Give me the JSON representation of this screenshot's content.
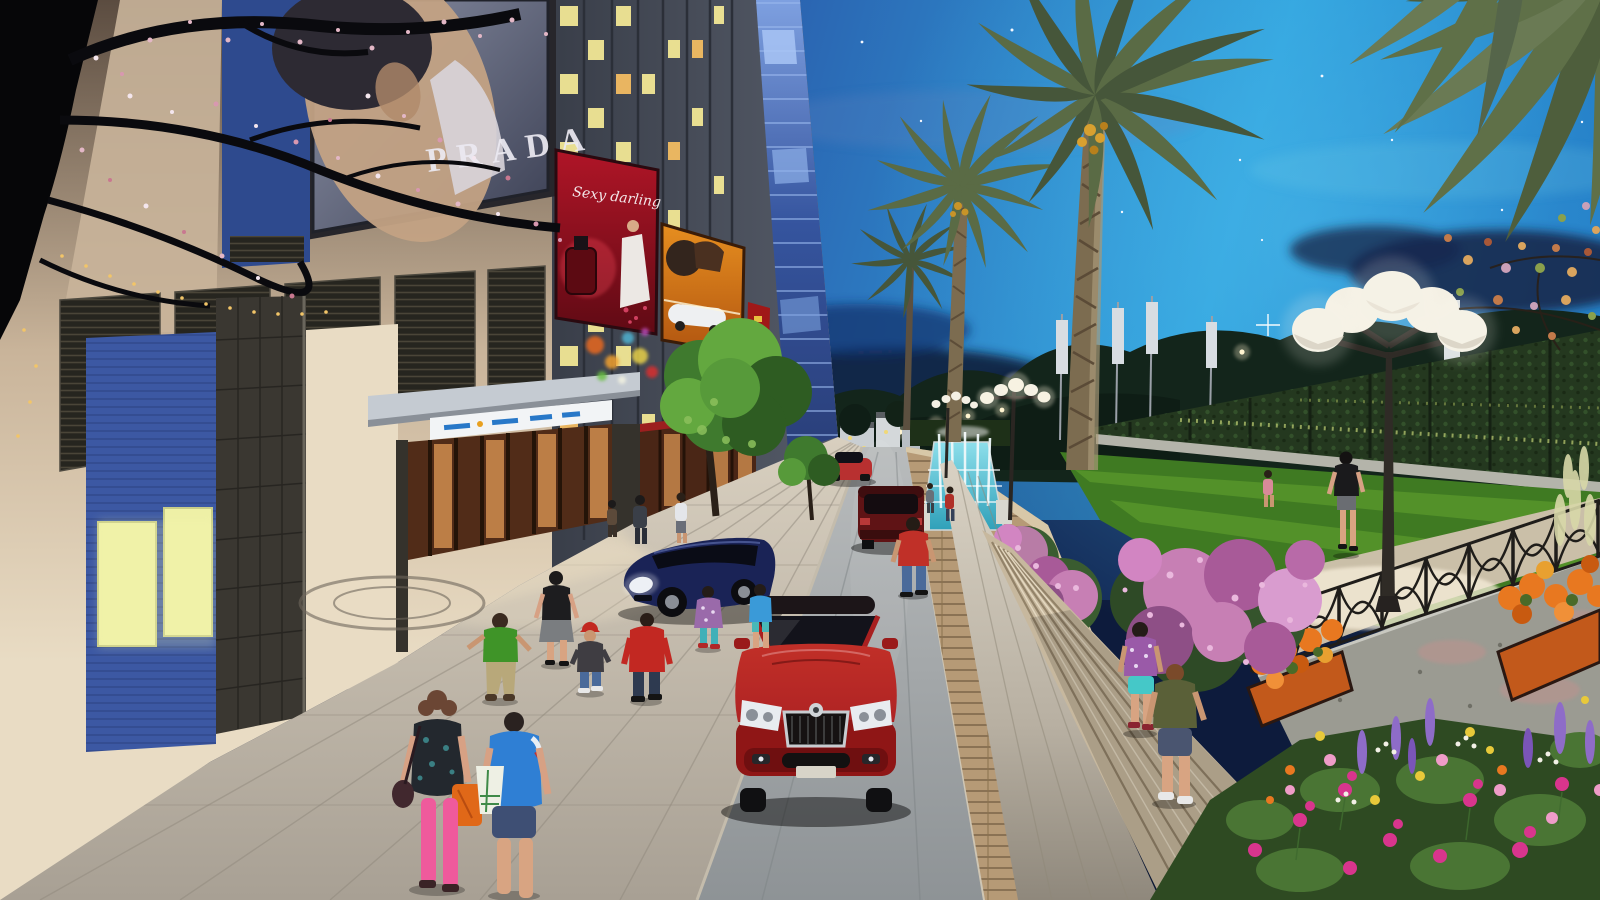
{
  "scene": {
    "kind": "architectural-rendering-evening-street",
    "billboards": {
      "fashion": "PRADA",
      "perfume_script": "Sexy darling"
    },
    "palette": {
      "sky_deep": "#1b2f66",
      "sky_mid": "#2a5cab",
      "sky_bright": "#2fa3de",
      "sky_glow": "#4db9ea",
      "cloud_dark": "#0e1c3c",
      "facade_top": "#5b4c40",
      "facade_beige": "#c9b49a",
      "facade_lit": "#e9dcc4",
      "tower_face": "#3a3f4a",
      "tower_face_light": "#555b68",
      "tower_glass": "#35549e",
      "tower_glass_light": "#7ea0e0",
      "window_lit": "#f2e795",
      "window_warm": "#f2bc62",
      "louver_dark": "#26251f",
      "granite_dark": "#3a3731",
      "accent_wall_blue": "#3c58a3",
      "accent_window": "#eef0a6",
      "billboard_red": "#b01527",
      "billboard_red_dark": "#5f0a14",
      "billboard_orange": "#e89020",
      "billboard_orange_dark": "#b05410",
      "canopy_grey": "#c5cbd2",
      "sign_band": "#f2f4f6",
      "sign_text_blue": "#2878c8",
      "shop_warm": "#4a2616",
      "shop_glow": "#cf8d4f",
      "plaza_near": "#a8a094",
      "plaza_far": "#d8cfbf",
      "road_near": "#8e9396",
      "road_far": "#b9bcbd",
      "stone_wall": "#b69a76",
      "concrete": "#9b9b92",
      "water": "#2d9fb8",
      "water_light": "#8fe0ec",
      "lawn": "#3f7a22",
      "lawn_stripe": "#64a42f",
      "hedge": "#24381f",
      "tree_green": "#3f7a2e",
      "tree_green_light": "#63a83f",
      "palm_frond": "#5a6b45",
      "palm_frond_dark": "#46563a",
      "palm_trunk": "#7c6c50",
      "lamp_globe": "#f4f0e4",
      "lamp_pole": "#2f2b26",
      "fence_iron": "#1f1d1a",
      "planter_orange": "#c2591b",
      "flower_orange": "#e87820",
      "flower_magenta": "#d8358d",
      "flower_pink": "#ef9cc8",
      "flower_yellow": "#e8c93a",
      "flower_purple": "#8e6cc8",
      "flower_white": "#f2f0e6",
      "bush_pink": "#c77fb4",
      "car_red": "#b02424",
      "car_red_dark": "#7c1212",
      "car_navy": "#1a2356",
      "suv_maroon": "#5f1315",
      "car_small_red": "#b83030",
      "blossom_pink": "#e3b7c6",
      "string_light": "#f2c568"
    },
    "objects": [
      "evening sky with stars and clouds",
      "high-rise tower with lit windows and blue glass corner",
      "PRADA fashion billboard",
      "red perfume billboard",
      "orange car billboard",
      "red vertical banner",
      "louvered facade panels",
      "blue accent wall with lit windows",
      "granite columns",
      "entrance canopy with sign band",
      "warm lit storefront",
      "bokeh fairy lights",
      "paved plaza with circular medallion",
      "street road",
      "red sedan front view",
      "navy parked car",
      "maroon suv",
      "small red car",
      "fountain with water jets",
      "pink flowering shrubs",
      "stone retaining wall",
      "promenade walkway",
      "stone steps",
      "ornamental iron fence",
      "orange flower planters",
      "flower bed with lupines and snapdragons",
      "concrete wall",
      "striped lawn",
      "vine-covered sports-field fence",
      "banner poles",
      "date palm trees",
      "globe street lamps",
      "autumn tree",
      "blossom tree silhouette",
      "pedestrians and children"
    ]
  }
}
